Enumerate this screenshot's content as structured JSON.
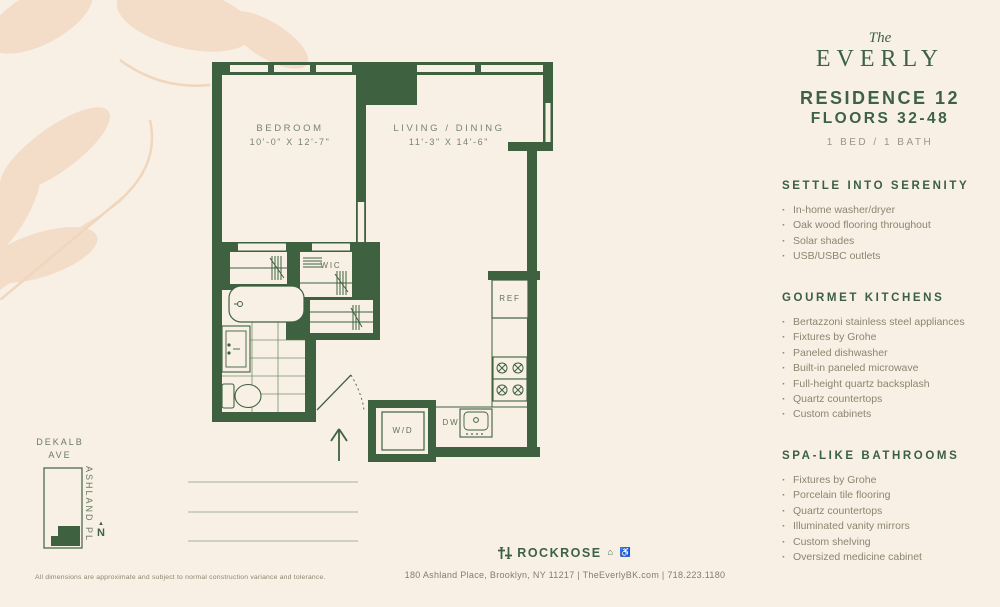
{
  "branding": {
    "script_word": "The",
    "name": "EVERLY"
  },
  "header": {
    "residence": "RESIDENCE 12",
    "floors": "FLOORS 32-48",
    "bed_bath": "1 BED / 1 BATH"
  },
  "lists": {
    "serenity": {
      "title": "SETTLE INTO SERENITY",
      "items": [
        "In-home washer/dryer",
        "Oak wood flooring throughout",
        "Solar shades",
        "USB/USBC outlets"
      ]
    },
    "kitchens": {
      "title": "GOURMET KITCHENS",
      "items": [
        "Bertazzoni stainless steel appliances",
        "Fixtures by Grohe",
        "Paneled dishwasher",
        "Built-in paneled microwave",
        "Full-height quartz backsplash",
        "Quartz countertops",
        "Custom cabinets"
      ]
    },
    "bathrooms": {
      "title": "SPA-LIKE BATHROOMS",
      "items": [
        "Fixtures by Grohe",
        "Porcelain tile flooring",
        "Quartz countertops",
        "Illuminated vanity mirrors",
        "Custom shelving",
        "Oversized medicine cabinet"
      ]
    }
  },
  "floorplan": {
    "bedroom_label": "BEDROOM",
    "bedroom_dims": "10'-0\" X 12'-7\"",
    "living_label": "LIVING / DINING",
    "living_dims": "11'-3\" X 14'-6\"",
    "wic_label": "WIC",
    "ref_label": "REF",
    "dw_label": "DW",
    "wd_label": "W/D"
  },
  "map": {
    "street_top_line1": "DEKALB",
    "street_top_line2": "AVE",
    "street_side": "ASHLAND PL",
    "north_label": "N",
    "north_arrow": "▲"
  },
  "footer": {
    "disclaimer": "All dimensions are approximate and subject to normal construction variance and tolerance.",
    "brand": "ROCKROSE",
    "icons": "⌂ ♿",
    "address_line": "180 Ashland Place, Brooklyn, NY 11217  |  TheEverlyBK.com  |  718.223.1180"
  },
  "colors": {
    "background": "#f8f0e4",
    "wall_green": "#3e6140",
    "heading_green": "#3c6147",
    "body_text": "#8b8570",
    "leaf_watermark": "#f3dcc8"
  }
}
